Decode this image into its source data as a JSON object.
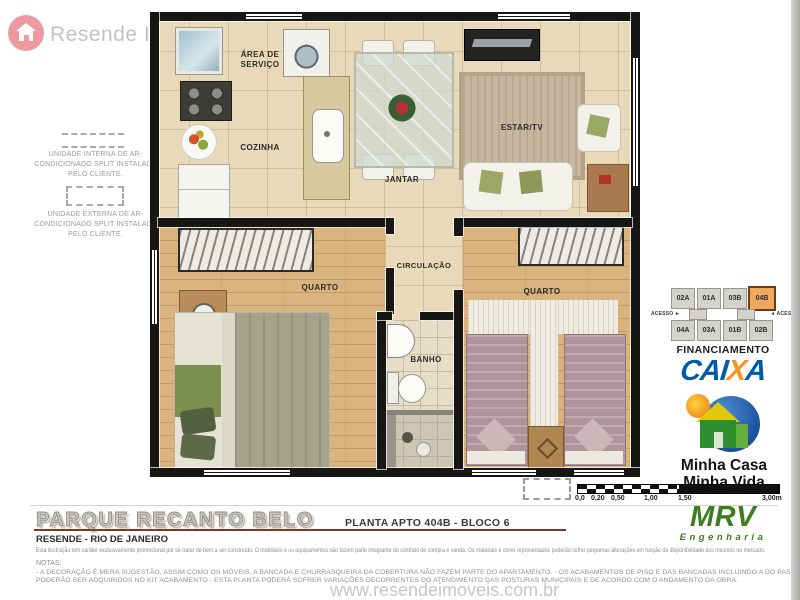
{
  "brand": {
    "name": "Resende Imóveis"
  },
  "site_watermark": "www.resendeimoveis.com.br",
  "legend": {
    "internal": "UNIDADE INTERNA DE AR-CONDICIONADO SPLIT INSTALADA PELO CLIENTE.",
    "external": "UNIDADE EXTERNA DE AR-CONDICIONADO SPLIT INSTALADA PELO CLIENTE."
  },
  "rooms": {
    "servico": "ÁREA DE SERVIÇO",
    "cozinha": "COZINHA",
    "jantar": "JANTAR",
    "estar": "ESTAR/TV",
    "quarto1": "QUARTO",
    "circulacao": "CIRCULAÇÃO",
    "banho": "BANHO",
    "quarto2": "QUARTO"
  },
  "keyplan": {
    "top_row": [
      "02A",
      "01A",
      "03B",
      "04B"
    ],
    "bottom_row": [
      "04A",
      "03A",
      "01B",
      "02B"
    ],
    "highlighted_unit": "04B",
    "access_left": "ACESSO ►",
    "access_right": "◄ ACESSO"
  },
  "caixa": {
    "heading": "FINANCIAMENTO",
    "word_parts": [
      "CAI",
      "X",
      "A"
    ]
  },
  "mcmv": {
    "line1": "Minha Casa",
    "line2": "Minha Vida"
  },
  "mrv": {
    "name": "MRV",
    "subtitle": "Engenharia"
  },
  "scalebar": {
    "ticks": [
      "0,0",
      "0,20",
      "0,50",
      "1,00",
      "1,50",
      "3,00m"
    ]
  },
  "footer": {
    "title": "PARQUE RECANTO BELO",
    "plan_ref": "PLANTA APTO 404B - BLOCO 6",
    "location": "RESENDE - RIO DE JANEIRO",
    "disclaimer": "Esta ilustração tem caráter exclusivamente promocional por se tratar de bem a ser construído. O mobiliário e os equipamentos não fazem parte integrante do contrato de compra e venda. Os materiais e cores representados poderão sofrer pequenas alterações em função da disponibilidade dos mesmos no mercado.",
    "notes_label": "NOTAS:",
    "notes": [
      "- A DECORAÇÃO É MERA SUGESTÃO, ASSIM COMO OS MÓVEIS, A BANCADA E CHURRASQUEIRA DA COBERTURA NÃO FAZEM PARTE DO APARTAMENTO. - OS ACABAMENTOS DE PISO E DAS BANCADAS INCLUINDO A DO PASSA PRATOS",
      "PODERÃO SER ADQUIRIDOS NO KIT ACABAMENTO - ESTA PLANTA PODERÁ SOFRER VARIAÇÕES DECORRENTES DO ATENDIMENTO DAS POSTURAS MUNICIPAIS E DE ACORDO COM O ANDAMENTO DA OBRA."
    ]
  },
  "colors": {
    "caixa_blue": "#005CA9",
    "caixa_orange": "#F7941E",
    "mrv_green": "#3C7D1F",
    "highlight_orange": "#F0A860",
    "wall": "#161614",
    "floor_tile": "#EAD9B9",
    "wood": "#D9B47E"
  }
}
